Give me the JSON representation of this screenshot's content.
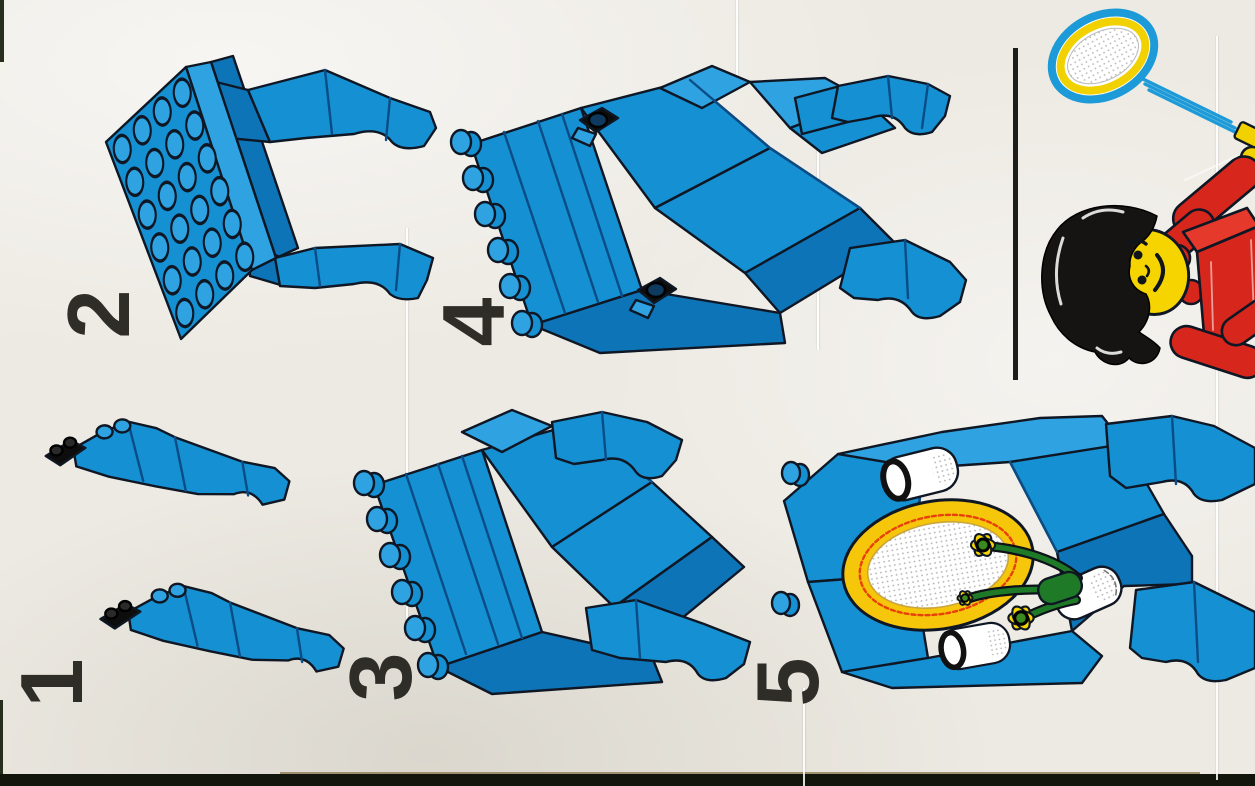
{
  "sheet": {
    "kind": "lego-building-instructions-scan",
    "paper_color": "#edeae3",
    "scan_edge_color": "#12150c",
    "number_color": "#2e2d28"
  },
  "steps": [
    {
      "number": "1",
      "illustration": "two-small-blue-leg-assemblies-with-black-plates"
    },
    {
      "number": "2",
      "illustration": "blue-studded-plate-with-two-curved-legs"
    },
    {
      "number": "3",
      "illustration": "blue-seat-assembly-with-side-studs-and-two-legs"
    },
    {
      "number": "4",
      "illustration": "blue-seat-assembly-with-two-black-clip-plates"
    },
    {
      "number": "5",
      "illustration": "blue-furniture-assembly-decorated-with-mirror-two-cups-and-flower-vase"
    }
  ],
  "corner_illustration": {
    "divider": "vertical-black-rule",
    "items": [
      "tennis-racket",
      "figure-black-hair-yellow-face-red-torso"
    ]
  },
  "colors": {
    "brick_blue": "#1590d2",
    "brick_blue_light": "#2fa3e2",
    "brick_blue_dark": "#0d74b8",
    "facet_line_navy": "#0a4c86",
    "outline": "#0f1724",
    "black_part": "#0d0d0d",
    "red": "#d7271d",
    "yellow": "#f2d100",
    "mirror_gold": "#f6c60a",
    "mirror_scallop_red": "#e8400a",
    "flower_green": "#1f7a28",
    "racket_frame_blue": "#1d9ad8",
    "racket_ring_yellow": "#f2d100"
  }
}
